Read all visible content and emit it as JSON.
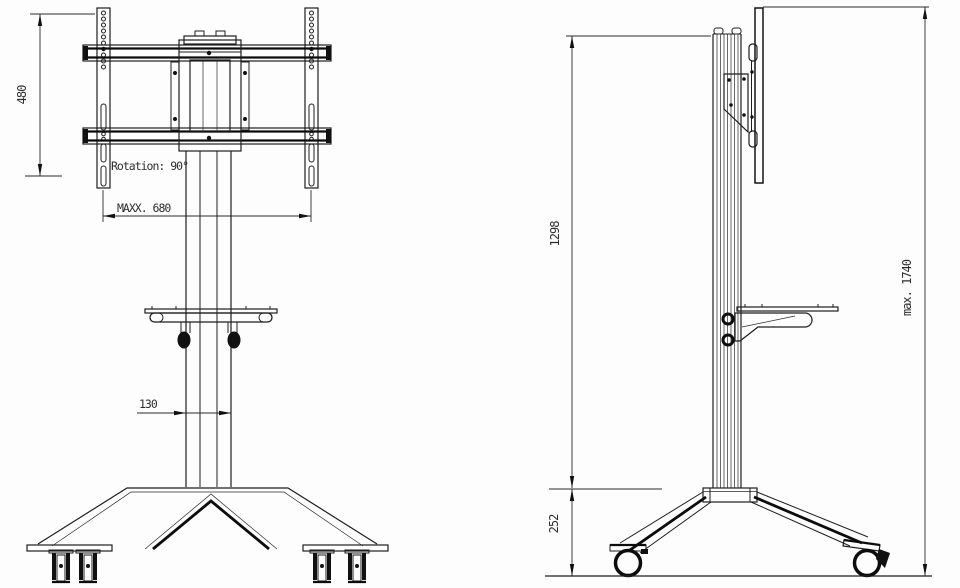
{
  "front_view": {
    "height_dim": "480",
    "rotation_label": "Rotation: 90°",
    "max_width_dim": "MAXX. 680",
    "column_width_dim": "130"
  },
  "side_view": {
    "upper_height_dim": "1298",
    "base_height_dim": "252",
    "max_height_dim": "max. 1740"
  }
}
